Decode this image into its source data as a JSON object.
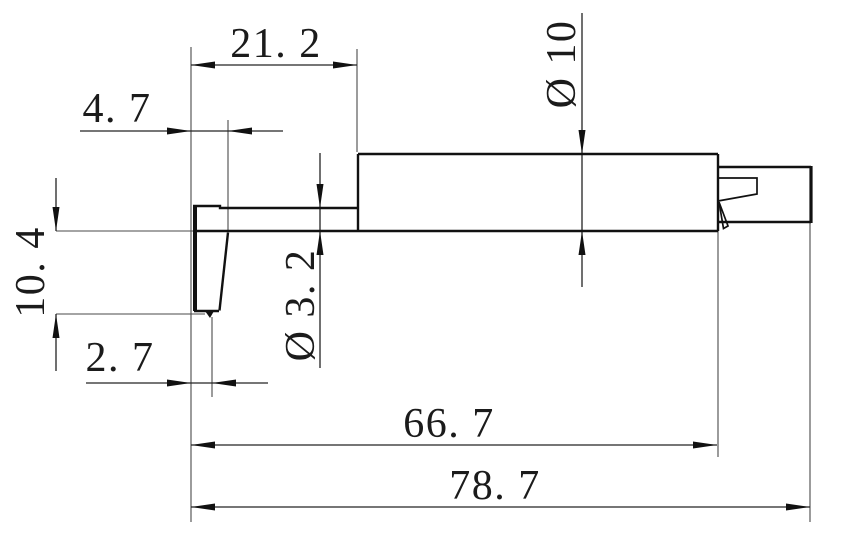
{
  "drawing": {
    "type": "engineering-dimension-drawing",
    "view": "side profile of a stylus probe with rear connector",
    "background_color": "#ffffff",
    "line_color": "#111111",
    "text_color": "#1b1b1b",
    "dimensions": [
      {
        "id": "top-width",
        "value": 21.2,
        "text": "21. 2",
        "orientation": "horizontal"
      },
      {
        "id": "tip-root-width",
        "value": 4.7,
        "text": "4. 7",
        "orientation": "horizontal"
      },
      {
        "id": "tip-drop-height",
        "value": 10.4,
        "text": "10. 4",
        "orientation": "vertical"
      },
      {
        "id": "arm-diameter",
        "value": 3.2,
        "text": "Ø 3. 2",
        "orientation": "vertical",
        "is_diameter": true
      },
      {
        "id": "body-diameter",
        "value": 10,
        "text": "Ø 10",
        "orientation": "vertical",
        "is_diameter": true
      },
      {
        "id": "tip-offset",
        "value": 2.7,
        "text": "2. 7",
        "orientation": "horizontal"
      },
      {
        "id": "body-length",
        "value": 66.7,
        "text": "66. 7",
        "orientation": "horizontal"
      },
      {
        "id": "overall-length",
        "value": 78.7,
        "text": "78. 7",
        "orientation": "horizontal"
      }
    ]
  }
}
